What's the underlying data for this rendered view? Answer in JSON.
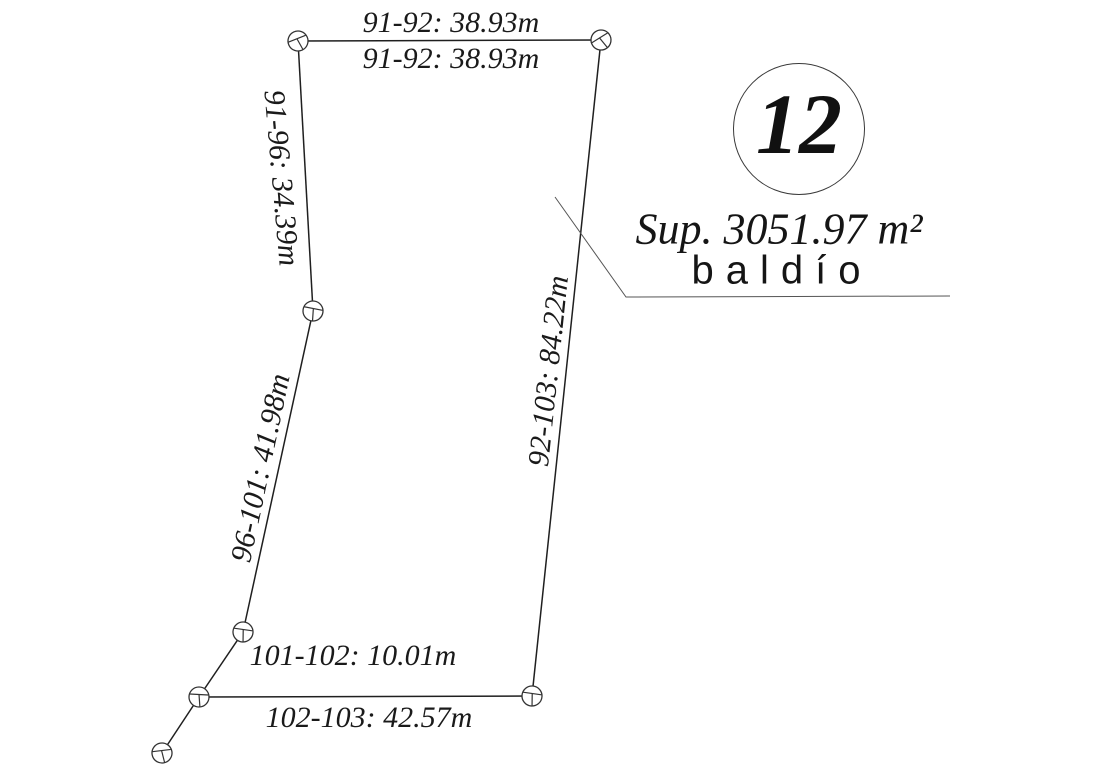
{
  "page": {
    "background": "#ffffff",
    "ink": "#1a1a1a",
    "line_color": "#1f1f1f"
  },
  "parcel": {
    "number": "12",
    "area_text": "Sup. 3051.97 m²",
    "land_use": "baldío"
  },
  "survey": {
    "points": [
      {
        "id": "91",
        "x": 298,
        "y": 41,
        "rot": -25
      },
      {
        "id": "92",
        "x": 601,
        "y": 40,
        "rot": -35
      },
      {
        "id": "96",
        "x": 313,
        "y": 311,
        "rot": 8
      },
      {
        "id": "101",
        "x": 243,
        "y": 632,
        "rot": 5
      },
      {
        "id": "102",
        "x": 199,
        "y": 697,
        "rot": 0
      },
      {
        "id": "103",
        "x": 532,
        "y": 696,
        "rot": 5
      },
      {
        "id": "aux-sw",
        "x": 162,
        "y": 753,
        "rot": -10
      }
    ],
    "edges": [
      {
        "from": "91",
        "to": "92"
      },
      {
        "from": "92",
        "to": "103"
      },
      {
        "from": "103",
        "to": "102"
      },
      {
        "from": "102",
        "to": "101"
      },
      {
        "from": "101",
        "to": "96"
      },
      {
        "from": "96",
        "to": "91"
      },
      {
        "from": "102",
        "to": "aux-sw"
      }
    ],
    "leader_points": "555,197 626,297 950,296",
    "labels": [
      {
        "text": "91-92: 38.93m",
        "x": 451,
        "y": 23,
        "rot": 0
      },
      {
        "text": "91-92: 38.93m",
        "x": 451,
        "y": 59,
        "rot": 0
      },
      {
        "text": "91-96: 34.39m",
        "x": 281,
        "y": 178,
        "rot": 85
      },
      {
        "text": "96-101: 41.98m",
        "x": 261,
        "y": 468,
        "rot": -78
      },
      {
        "text": "92-103: 84.22m",
        "x": 549,
        "y": 371,
        "rot": -84
      },
      {
        "text": "101-102: 10.01m",
        "x": 353,
        "y": 656,
        "rot": 0
      },
      {
        "text": "102-103: 42.57m",
        "x": 369,
        "y": 718,
        "rot": 0
      }
    ]
  }
}
